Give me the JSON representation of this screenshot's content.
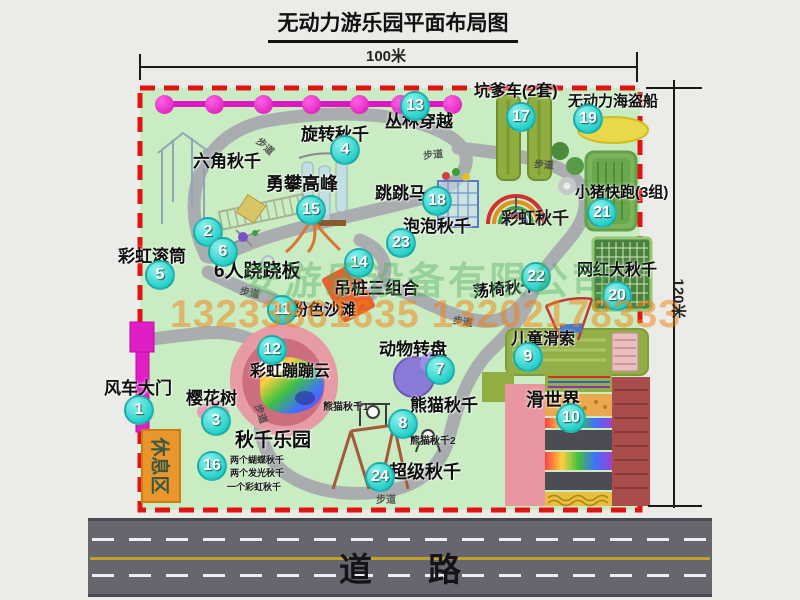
{
  "title": "无动力游乐园平面布局图",
  "dimensions": {
    "width": "100米",
    "height": "120米"
  },
  "road": {
    "label": "道路"
  },
  "watermarks": {
    "company": "安游乐设备有限公司",
    "phone": "13233861635 13202178333"
  },
  "rest_area": "休息区",
  "path_sign_label": "步道",
  "path_signs": [
    {
      "x": 256,
      "y": 138,
      "r": 42
    },
    {
      "x": 423,
      "y": 146,
      "r": -6
    },
    {
      "x": 534,
      "y": 156,
      "r": 4
    },
    {
      "x": 240,
      "y": 284,
      "r": 12
    },
    {
      "x": 453,
      "y": 313,
      "r": 10
    },
    {
      "x": 252,
      "y": 406,
      "r": 72
    },
    {
      "x": 376,
      "y": 491,
      "r": 0
    }
  ],
  "zipline": {
    "balls_x": [
      164,
      214,
      263,
      311,
      359,
      400,
      452
    ],
    "y": 104
  },
  "attractions": [
    {
      "num": 1,
      "name": "风车大门",
      "mx": 139,
      "my": 410,
      "lx": 104,
      "ly": 380,
      "fs": 17
    },
    {
      "num": 2,
      "name": "六角秋千",
      "mx": 208,
      "my": 232,
      "lx": 193,
      "ly": 153,
      "fs": 17
    },
    {
      "num": 3,
      "name": "樱花树",
      "mx": 216,
      "my": 421,
      "lx": 186,
      "ly": 390,
      "fs": 17
    },
    {
      "num": 4,
      "name": "旋转秋千",
      "mx": 345,
      "my": 150,
      "lx": 301,
      "ly": 126,
      "fs": 17
    },
    {
      "num": 5,
      "name": "彩虹滚筒",
      "mx": 160,
      "my": 275,
      "lx": 118,
      "ly": 248,
      "fs": 17
    },
    {
      "num": 6,
      "name": "6人跷跷板",
      "mx": 223,
      "my": 252,
      "lx": 214,
      "ly": 262,
      "fs": 19
    },
    {
      "num": 7,
      "name": "动物转盘",
      "mx": 440,
      "my": 370,
      "lx": 379,
      "ly": 341,
      "fs": 17
    },
    {
      "num": 8,
      "name": "熊猫秋千",
      "mx": 403,
      "my": 424,
      "lx": 410,
      "ly": 397,
      "fs": 17
    },
    {
      "num": 9,
      "name": "儿童滑索",
      "mx": 528,
      "my": 357,
      "lx": 511,
      "ly": 332,
      "fs": 16
    },
    {
      "num": 10,
      "name": "滑世界",
      "mx": 571,
      "my": 418,
      "lx": 526,
      "ly": 391,
      "fs": 18
    },
    {
      "num": 11,
      "name": "粉色沙滩",
      "mx": 282,
      "my": 310,
      "lx": 292,
      "ly": 303,
      "fs": 16
    },
    {
      "num": 12,
      "name": "彩虹蹦蹦云",
      "mx": 272,
      "my": 350,
      "lx": 250,
      "ly": 364,
      "fs": 16
    },
    {
      "num": 13,
      "name": "丛林穿越",
      "mx": 415,
      "my": 106,
      "lx": 385,
      "ly": 113,
      "fs": 17
    },
    {
      "num": 14,
      "name": "吊桩三组合",
      "mx": 359,
      "my": 263,
      "lx": 334,
      "ly": 280,
      "fs": 17
    },
    {
      "num": 15,
      "name": "勇攀高峰",
      "mx": 311,
      "my": 210,
      "lx": 266,
      "ly": 175,
      "fs": 18
    },
    {
      "num": 16,
      "name": "秋千乐园",
      "mx": 212,
      "my": 466,
      "lx": 235,
      "ly": 431,
      "fs": 19
    },
    {
      "num": 17,
      "name": "坑爹车(2套)",
      "mx": 521,
      "my": 117,
      "lx": 474,
      "ly": 84,
      "fs": 16
    },
    {
      "num": 18,
      "name": "跳跳马",
      "mx": 437,
      "my": 201,
      "lx": 375,
      "ly": 185,
      "fs": 17
    },
    {
      "num": 19,
      "name": "无动力海盗船",
      "mx": 588,
      "my": 119,
      "lx": 568,
      "ly": 94,
      "fs": 15
    },
    {
      "num": 20,
      "name": "网红大秋千",
      "mx": 617,
      "my": 296,
      "lx": 577,
      "ly": 263,
      "fs": 16
    },
    {
      "num": 21,
      "name": "小猪快跑(3组)",
      "mx": 602,
      "my": 213,
      "lx": 575,
      "ly": 185,
      "fs": 15
    },
    {
      "num": 22,
      "name": "荡椅秋千",
      "mx": 536,
      "my": 277,
      "lx": 473,
      "ly": 282,
      "fs": 16,
      "rot": -6
    },
    {
      "num": 23,
      "name": "泡泡秋千",
      "mx": 401,
      "my": 243,
      "lx": 403,
      "ly": 218,
      "fs": 17
    },
    {
      "num": 24,
      "name": "超级秋千",
      "mx": 380,
      "my": 477,
      "lx": 389,
      "ly": 463,
      "fs": 18
    }
  ],
  "sub_labels": [
    {
      "text": "彩虹秋千",
      "x": 501,
      "y": 210,
      "fs": 17
    },
    {
      "text": "熊猫秋千1",
      "x": 323,
      "y": 403,
      "fs": 10
    },
    {
      "text": "熊猫秋千2",
      "x": 410,
      "y": 437,
      "fs": 10
    },
    {
      "text": "两个蝴蝶秋千",
      "x": 230,
      "y": 456,
      "fs": 9
    },
    {
      "text": "两个发光秋千",
      "x": 230,
      "y": 469,
      "fs": 9
    },
    {
      "text": "一个彩虹秋千",
      "x": 227,
      "y": 483,
      "fs": 9
    }
  ],
  "colors": {
    "park_fill": "#c9ecc3",
    "boundary_red": "#e11414",
    "path_gray": "#a9adb0",
    "marker_teal": "#23cec8",
    "zipline_magenta": "#de16c0",
    "gate_magenta": "#df1ec6",
    "rest_area_orange": "#e9972c",
    "road_gray": "#66666e",
    "road_yellow": "#bfa028",
    "watermark_green": "#52aa5a",
    "watermark_orange": "#f28010"
  }
}
